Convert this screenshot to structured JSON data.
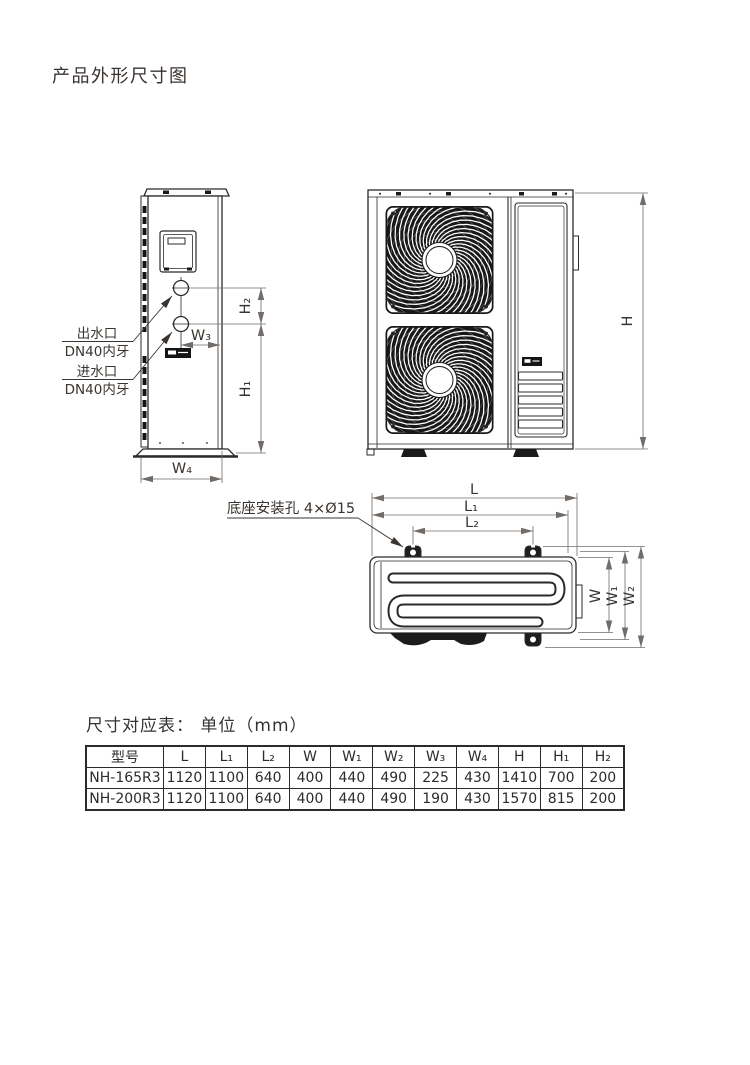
{
  "page": {
    "title": "产品外形尺寸图"
  },
  "colors": {
    "ink": "#2e2a28",
    "dim": "#716c68",
    "text": "#3a3531",
    "dark_fill": "#1a1a1a"
  },
  "side_view": {
    "outlet_label_line1": "出水口",
    "outlet_label_line2": "DN40内牙",
    "inlet_label_line1": "进水口",
    "inlet_label_line2": "DN40内牙",
    "dim_h1": "H₁",
    "dim_h2": "H₂",
    "dim_w3": "W₃",
    "dim_w4": "W₄"
  },
  "front_view": {
    "dim_h": "H"
  },
  "top_view": {
    "mounting_note": "底座安装孔 4×Ø15",
    "dim_l": "L",
    "dim_l1": "L₁",
    "dim_l2": "L₂",
    "dim_w": "W",
    "dim_w1": "W₁",
    "dim_w2": "W₂"
  },
  "table": {
    "title": "尺寸对应表： 单位（mm）",
    "headers": [
      "型号",
      "L",
      "L₁",
      "L₂",
      "W",
      "W₁",
      "W₂",
      "W₃",
      "W₄",
      "H",
      "H₁",
      "H₂"
    ],
    "rows": [
      [
        "NH-165R3",
        "1120",
        "1100",
        "640",
        "400",
        "440",
        "490",
        "225",
        "430",
        "1410",
        "700",
        "200"
      ],
      [
        "NH-200R3",
        "1120",
        "1100",
        "640",
        "400",
        "440",
        "490",
        "190",
        "430",
        "1570",
        "815",
        "200"
      ]
    ]
  }
}
